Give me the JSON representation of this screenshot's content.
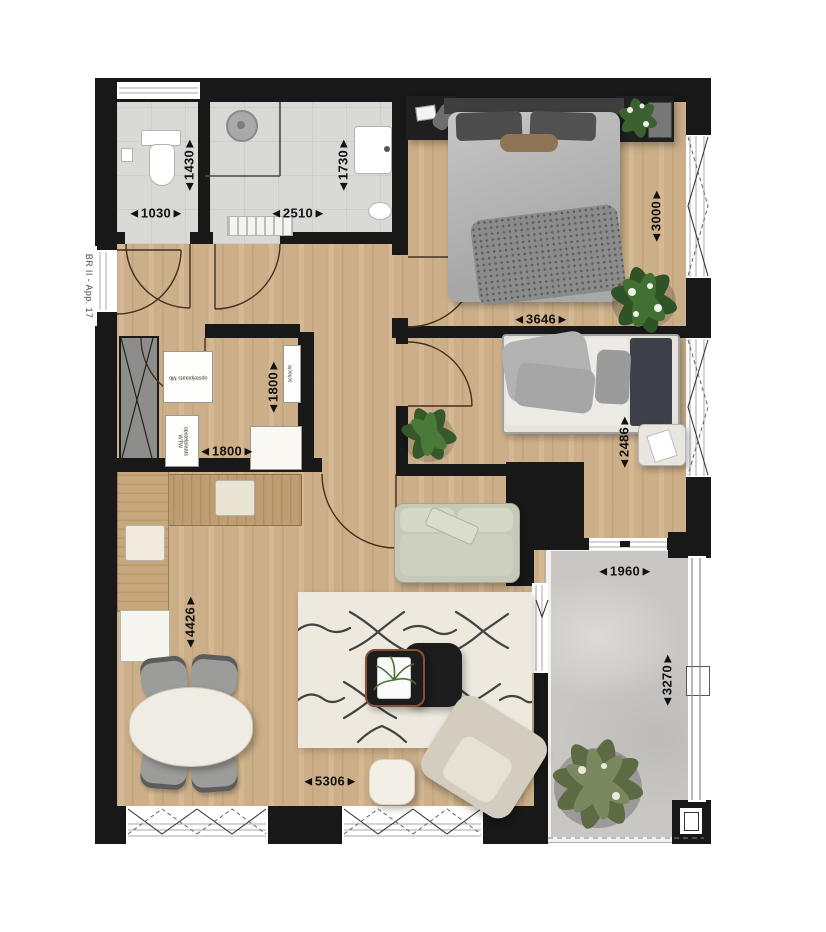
{
  "plan": {
    "labels": {
      "unit": "BR II - App. 17",
      "equip_mb": "opstelplaats Mb",
      "equip_wtw": "opstelplaats WTW",
      "shaft": "schacht"
    },
    "dimensions": {
      "toilet_w": "◄1030►",
      "toilet_d": "◄1430►",
      "bath_w": "◄2510►",
      "bath_d": "◄1730►",
      "bed1_d": "◄3000►",
      "bed1_w": "◄3646►",
      "storage_d": "◄1800►",
      "storage_w": "◄1800►",
      "bed2_d": "◄2486►",
      "living_d": "◄4426►",
      "living_w": "◄5306►",
      "balcony_w": "◄1960►",
      "balcony_d": "◄3270►"
    },
    "colors": {
      "wall": "#181818",
      "wood_floor": "#d3b58d",
      "tile_floor": "#d9d9d6",
      "balcony_concrete": "#c8c7c4",
      "plant_green": "#3f6132"
    }
  }
}
